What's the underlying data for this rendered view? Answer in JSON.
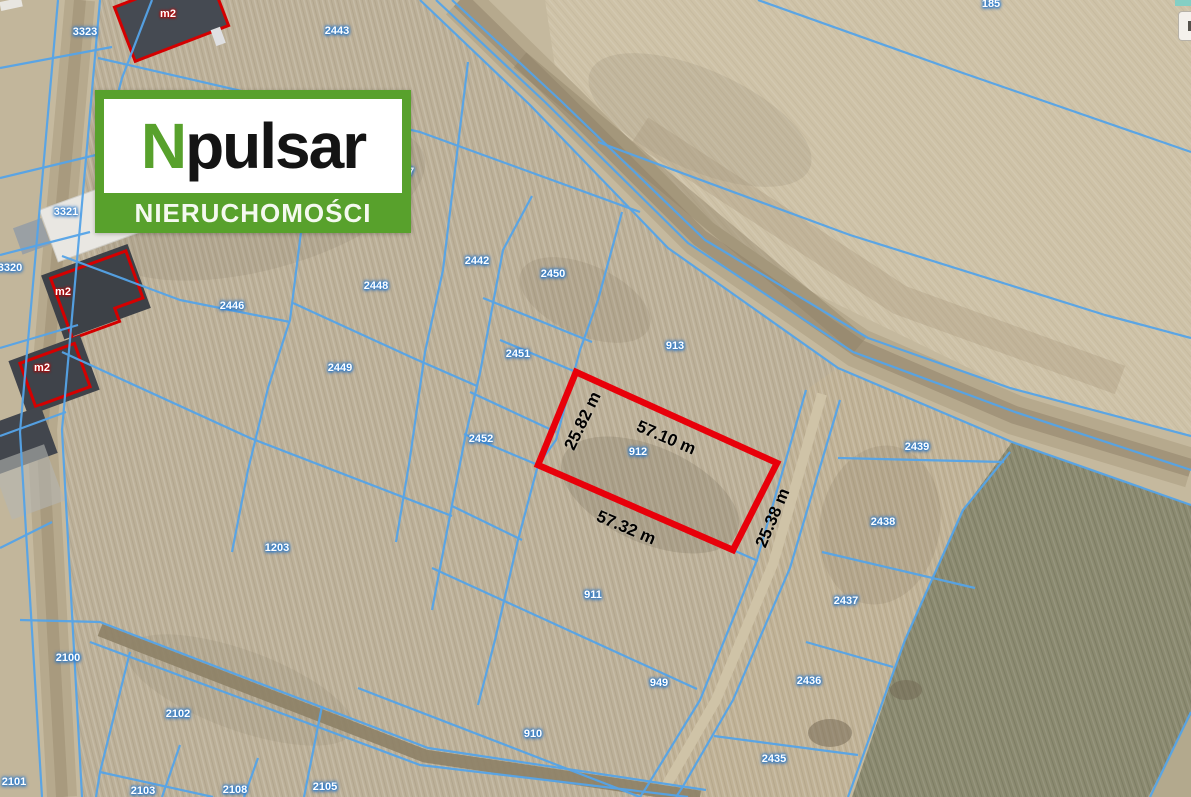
{
  "logo": {
    "n": "N",
    "name": "pulsar",
    "tagline": "NIERUCHOMOŚCI",
    "green": "#58a12c"
  },
  "map": {
    "parcel_labels": [
      {
        "text": "3323",
        "x": 85,
        "y": 32
      },
      {
        "text": "2443",
        "x": 337,
        "y": 31
      },
      {
        "text": "185",
        "x": 991,
        "y": 4
      },
      {
        "text": "3321",
        "x": 66,
        "y": 212
      },
      {
        "text": "3320",
        "x": 10,
        "y": 268
      },
      {
        "text": "47",
        "x": 408,
        "y": 172
      },
      {
        "text": "2442",
        "x": 477,
        "y": 261
      },
      {
        "text": "2450",
        "x": 553,
        "y": 274
      },
      {
        "text": "2448",
        "x": 376,
        "y": 286
      },
      {
        "text": "2446",
        "x": 232,
        "y": 306
      },
      {
        "text": "2451",
        "x": 518,
        "y": 354
      },
      {
        "text": "913",
        "x": 675,
        "y": 346
      },
      {
        "text": "2449",
        "x": 340,
        "y": 368
      },
      {
        "text": "2452",
        "x": 481,
        "y": 439
      },
      {
        "text": "912",
        "x": 638,
        "y": 452
      },
      {
        "text": "2439",
        "x": 917,
        "y": 447
      },
      {
        "text": "2438",
        "x": 883,
        "y": 522
      },
      {
        "text": "1203",
        "x": 277,
        "y": 548
      },
      {
        "text": "911",
        "x": 593,
        "y": 595
      },
      {
        "text": "2437",
        "x": 846,
        "y": 601
      },
      {
        "text": "2100",
        "x": 68,
        "y": 658
      },
      {
        "text": "949",
        "x": 659,
        "y": 683
      },
      {
        "text": "2436",
        "x": 809,
        "y": 681
      },
      {
        "text": "2102",
        "x": 178,
        "y": 714
      },
      {
        "text": "910",
        "x": 533,
        "y": 734
      },
      {
        "text": "2435",
        "x": 774,
        "y": 759
      },
      {
        "text": "2101",
        "x": 14,
        "y": 782
      },
      {
        "text": "2103",
        "x": 143,
        "y": 791
      },
      {
        "text": "2108",
        "x": 235,
        "y": 790
      },
      {
        "text": "2105",
        "x": 325,
        "y": 787
      }
    ],
    "dimension_labels": [
      {
        "text": "25.82 m",
        "x": 583,
        "y": 421,
        "angle": -64
      },
      {
        "text": "57.10 m",
        "x": 666,
        "y": 438,
        "angle": 23
      },
      {
        "text": "57.32 m",
        "x": 626,
        "y": 528,
        "angle": 23
      },
      {
        "text": "25.38 m",
        "x": 773,
        "y": 518,
        "angle": -67
      }
    ],
    "building_labels": [
      {
        "text": "m2",
        "x": 168,
        "y": 14
      },
      {
        "text": "m2",
        "x": 63,
        "y": 292
      },
      {
        "text": "m2",
        "x": 42,
        "y": 368
      }
    ],
    "highlighted_parcel": {
      "number": "912",
      "width_top": "57.10 m",
      "width_bottom": "57.32 m",
      "side_left": "25.82 m",
      "side_right": "25.38 m"
    },
    "colors": {
      "boundary": "#55a4e8",
      "highlight": "#e8000a",
      "label": "#ffffff",
      "label_halo": "#2f7fd0"
    }
  }
}
